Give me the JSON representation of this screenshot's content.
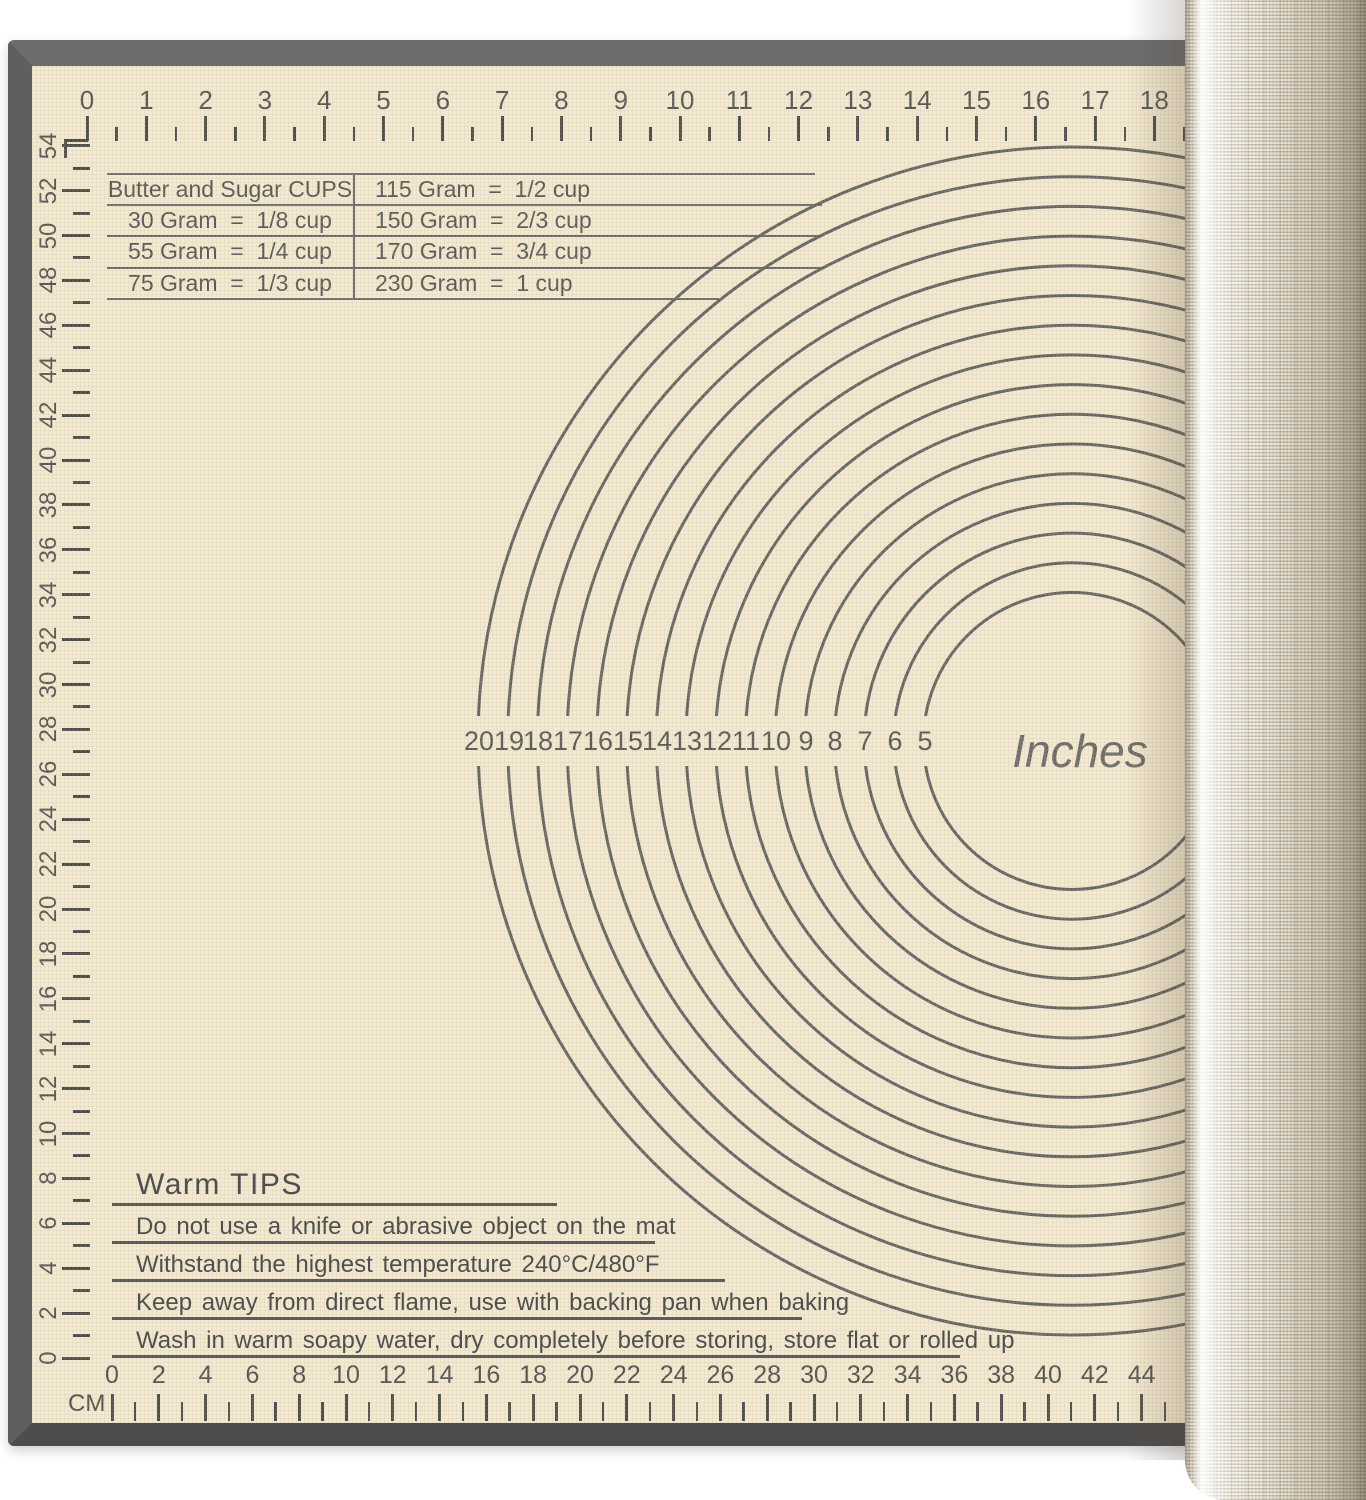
{
  "colors": {
    "background": "#ffffff",
    "mat_surface": "#f2e9d1",
    "mat_border": "#6d6d6d",
    "ink": "#555555",
    "line": "#646464",
    "roll_base": "#e6dfcd"
  },
  "top_ruler": {
    "labels": [
      "0",
      "1",
      "2",
      "3",
      "4",
      "5",
      "6",
      "7",
      "8",
      "9",
      "10",
      "11",
      "12",
      "13",
      "14",
      "15",
      "16",
      "17",
      "18"
    ]
  },
  "left_ruler": {
    "labels": [
      "54",
      "52",
      "50",
      "48",
      "46",
      "44",
      "42",
      "40",
      "38",
      "36",
      "34",
      "32",
      "30",
      "28",
      "26",
      "24",
      "22",
      "20",
      "18",
      "16",
      "14",
      "12",
      "10",
      "8",
      "6",
      "4",
      "2",
      "0"
    ],
    "max_cm": 54
  },
  "bottom_ruler": {
    "unit_label": "CM",
    "labels": [
      "0",
      "2",
      "4",
      "6",
      "8",
      "10",
      "12",
      "14",
      "16",
      "18",
      "20",
      "22",
      "24",
      "26",
      "28",
      "30",
      "32",
      "34",
      "36",
      "38",
      "40",
      "42",
      "44"
    ],
    "max_cm": 46
  },
  "conversion_table": {
    "rows": [
      [
        "Butter and Sugar CUPS",
        "115 Gram  =  1/2 cup"
      ],
      [
        "30 Gram  =  1/8 cup",
        "150 Gram  =  2/3 cup"
      ],
      [
        "55 Gram  =  1/4 cup",
        "170 Gram  =  3/4 cup"
      ],
      [
        "75 Gram  =  1/3 cup",
        "230 Gram  =  1 cup"
      ]
    ]
  },
  "circle_guide": {
    "unit_label": "Inches",
    "diameter_labels": [
      "20",
      "19",
      "18",
      "17",
      "16",
      "15",
      "14",
      "13",
      "12",
      "11",
      "10",
      "9",
      "8",
      "7",
      "6",
      "5"
    ],
    "diameters_inches": [
      20,
      19,
      18,
      17,
      16,
      15,
      14,
      13,
      12,
      11,
      10,
      9,
      8,
      7,
      6,
      5
    ]
  },
  "warm_tips": {
    "heading": "Warm TIPS",
    "tips": [
      "Do not use a knife or abrasive object on the mat",
      "Withstand the highest temperature 240°C/480°F",
      "Keep away from direct flame, use with backing pan when baking",
      "Wash in warm soapy water, dry completely before storing, store flat or rolled up"
    ]
  }
}
